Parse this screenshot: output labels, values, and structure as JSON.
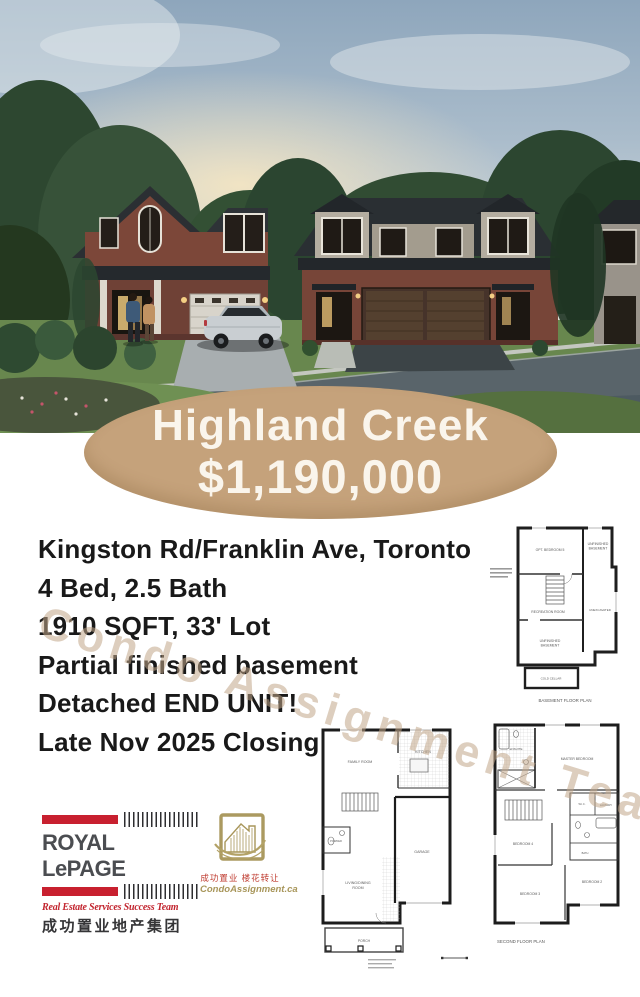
{
  "flyer": {
    "badge": {
      "community": "Highland Creek",
      "price": "$1,190,000"
    },
    "details": [
      "Kingston Rd/Franklin Ave, Toronto",
      "4 Bed, 2.5 Bath",
      "1910 SQFT, 33' Lot",
      "Partial finished basement",
      "Detached END UNIT!",
      "Late Nov 2025 Closing"
    ],
    "watermark": "Condo Assignment Team"
  },
  "branding": {
    "royal_lepage": {
      "wordmark": "ROYAL LePAGE",
      "tagline": "Real Estate Services Success Team",
      "chinese": "成功置业地产集团"
    },
    "condo_assignment": {
      "chinese": "成功置业 楼花转让",
      "website": "CondoAssignment.ca"
    }
  },
  "floor_plans": {
    "basement": {
      "caption": "BASEMENT FLOOR PLAN",
      "rooms": {
        "opt_bedroom": "OPT. BEDROOM 5",
        "unfinished_1": "UNFINISHED",
        "unfinished_2": "BASEMENT",
        "recreation": "RECREATION ROOM",
        "unexcavated": "UNEXCAVATED",
        "cold_cellar": "COLD CELLAR"
      }
    },
    "ground": {
      "rooms": {
        "family": "FAMILY ROOM",
        "kitchen": "KITCHEN",
        "garage": "GARAGE",
        "living_1": "LIVING/DINING",
        "living_2": "ROOM",
        "powder": "POWDER",
        "porch": "PORCH"
      }
    },
    "second": {
      "caption": "SECOND FLOOR PLAN",
      "rooms": {
        "ensuite": "ENSUITE",
        "master": "MASTER BEDROOM",
        "wic": "W.I.C.",
        "bath": "BATH",
        "laundry": "LAUNDRY",
        "bedroom4": "BEDROOM 4",
        "bedroom3": "BEDROOM 3",
        "bedroom2": "BEDROOM 2"
      }
    }
  },
  "colors": {
    "badge_bg": "#c5a27b",
    "badge_text": "#faf5ec",
    "rlp_red": "#c8202f",
    "ca_gold": "#a8965a",
    "watermark": "rgba(193,166,137,0.55)",
    "body_text": "#191919"
  }
}
